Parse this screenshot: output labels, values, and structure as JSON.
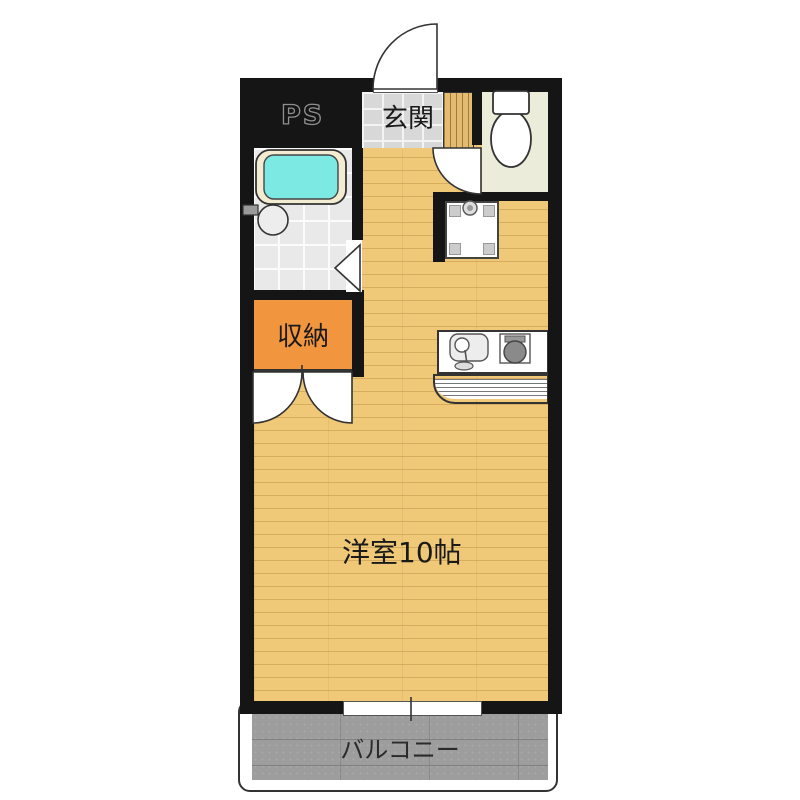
{
  "floorplan": {
    "type": "japanese-apartment-floorplan",
    "rooms": [
      {
        "id": "pipe-space",
        "label": "PS"
      },
      {
        "id": "entrance",
        "label": "玄関"
      },
      {
        "id": "closet",
        "label": "収納"
      },
      {
        "id": "western-room",
        "label": "洋室10帖"
      },
      {
        "id": "balcony",
        "label": "バルコニー"
      }
    ],
    "fixtures": [
      "entry-door-swing",
      "toilet",
      "toilet-door-swing",
      "bathtub",
      "wash-basin",
      "bathroom-door-marker",
      "closet-double-door-swing",
      "washing-machine-pan",
      "kitchen-sink",
      "stove-burner",
      "balcony-window"
    ],
    "colors": {
      "wall": "#151515",
      "wood": "#EFC878",
      "step_wood": "#E3BC72",
      "tile": "#D8D8D8",
      "toilet_floor": "#ECECDA",
      "bath_tile": "#E9E9E9",
      "bathtub_cyan": "#7CE9E3",
      "tub_rim": "#F4ECD2",
      "closet_orange": "#F2953F",
      "balcony_gray": "#9D9D9D"
    }
  }
}
